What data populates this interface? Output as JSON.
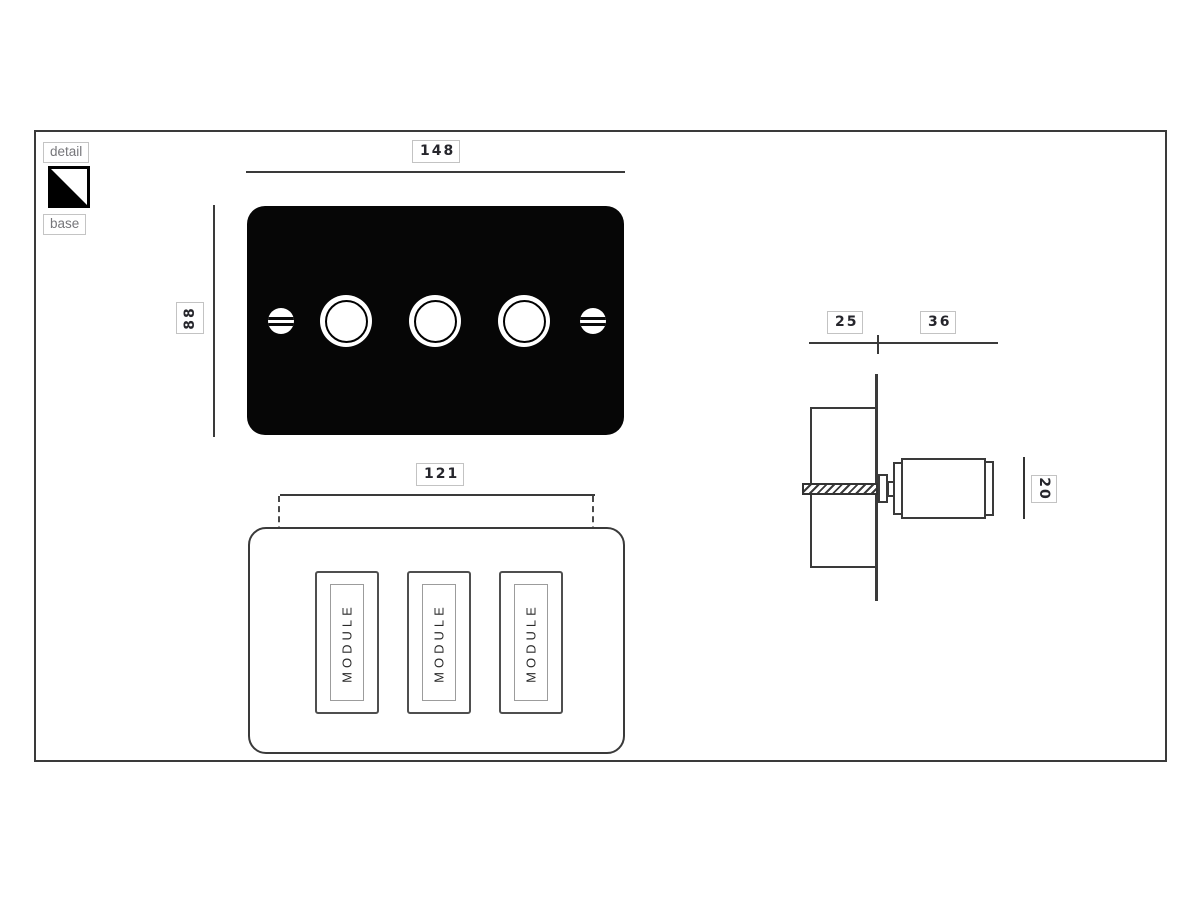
{
  "legend": {
    "detail_label": "detail",
    "base_label": "base",
    "swatch": {
      "detail_color": "#ffffff",
      "base_color": "#000000"
    }
  },
  "front_view": {
    "width_dim": "148",
    "height_dim": "88",
    "plate_color": "#000000",
    "knob_count": 3,
    "screw_count": 2
  },
  "back_view": {
    "spacing_dim": "121",
    "module_labels": [
      "MODULE",
      "MODULE",
      "MODULE"
    ]
  },
  "side_view": {
    "box_depth_dim": "25",
    "knob_depth_dim": "36",
    "knob_height_dim": "20"
  },
  "colors": {
    "line": "#3a3a3a",
    "dim_text": "#26262c",
    "chip_border": "#c3c3c3"
  }
}
